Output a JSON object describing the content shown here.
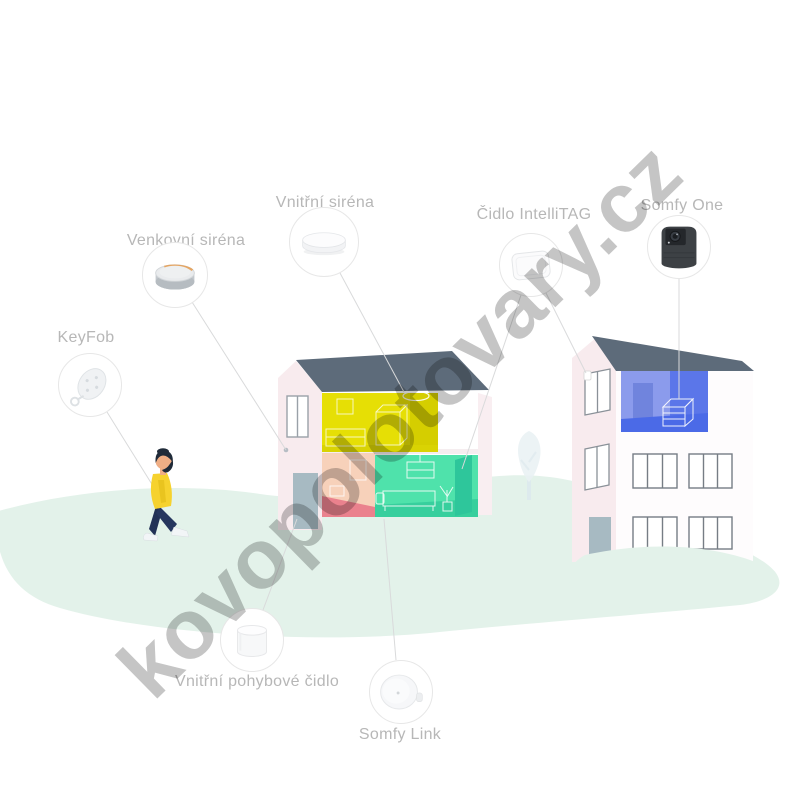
{
  "watermark": {
    "text": "kovopolotovary.cz",
    "color": "#c5c5c5"
  },
  "devices": {
    "keyfob": {
      "label": "KeyFob",
      "icon": "keyfob-remote-icon"
    },
    "outdoor_siren": {
      "label": "Venkovní siréna",
      "icon": "outdoor-siren-icon"
    },
    "indoor_siren": {
      "label": "Vnitřní siréna",
      "icon": "indoor-siren-icon"
    },
    "intellitag": {
      "label": "Čidlo IntelliTAG",
      "icon": "intellitag-sensor-icon"
    },
    "somfy_one": {
      "label": "Somfy One",
      "icon": "security-camera-icon"
    },
    "motion_sensor": {
      "label": "Vnitřní pohybové čidlo",
      "icon": "motion-sensor-icon"
    },
    "somfy_link": {
      "label": "Somfy Link",
      "icon": "hub-link-icon"
    }
  },
  "colors": {
    "label_gray": "#b7b7b7",
    "roof_slate": "#5d6b7a",
    "wall_pink": "#f8ebee",
    "room_yellow": "#e6df05",
    "room_salmon": "#f7d1ba",
    "room_green": "#4fe2ab",
    "room_blue": "#8b9bec",
    "ground_green": "#e3f2ea",
    "siren_accent_orange": "#e59a4b",
    "person_sweater_yellow": "#f6d22e",
    "person_pants_navy": "#223156"
  }
}
